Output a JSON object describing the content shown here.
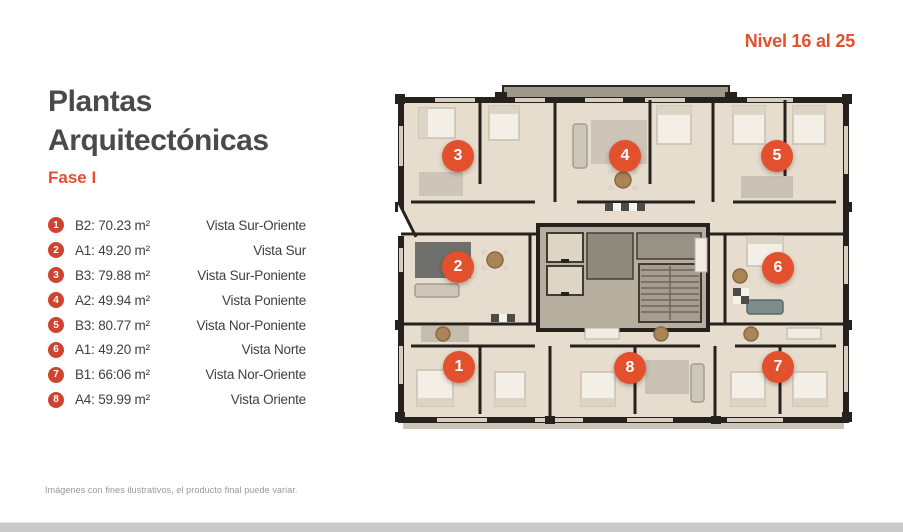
{
  "page": {
    "level_label": "Nivel 16 al 25",
    "title_line1": "Plantas",
    "title_line2": "Arquitectónicas",
    "phase": "Fase I",
    "disclaimer": "Imágenes con fines ilustrativos, el producto final puede variar."
  },
  "colors": {
    "accent": "#E3502E",
    "legend_badge": "#CE4430",
    "title_text": "#4A4A4C",
    "body_text": "#3F3F41",
    "muted_text": "#989898"
  },
  "legend": {
    "items": [
      {
        "num": "1",
        "unit": "B2: 70.23 m²",
        "vista": "Vista Sur-Oriente"
      },
      {
        "num": "2",
        "unit": "A1: 49.20 m²",
        "vista": "Vista Sur"
      },
      {
        "num": "3",
        "unit": "B3: 79.88 m²",
        "vista": "Vista Sur-Poniente"
      },
      {
        "num": "4",
        "unit": "A2: 49.94 m²",
        "vista": "Vista Poniente"
      },
      {
        "num": "5",
        "unit": "B3: 80.77 m²",
        "vista": "Vista Nor-Poniente"
      },
      {
        "num": "6",
        "unit": "A1: 49.20 m²",
        "vista": "Vista Norte"
      },
      {
        "num": "7",
        "unit": "B1: 66:06 m²",
        "vista": "Vista Nor-Oriente"
      },
      {
        "num": "8",
        "unit": "A4: 59.99 m²",
        "vista": "Vista Oriente"
      }
    ]
  },
  "floor_plan": {
    "markers": [
      "1",
      "2",
      "3",
      "4",
      "5",
      "6",
      "7",
      "8"
    ]
  }
}
